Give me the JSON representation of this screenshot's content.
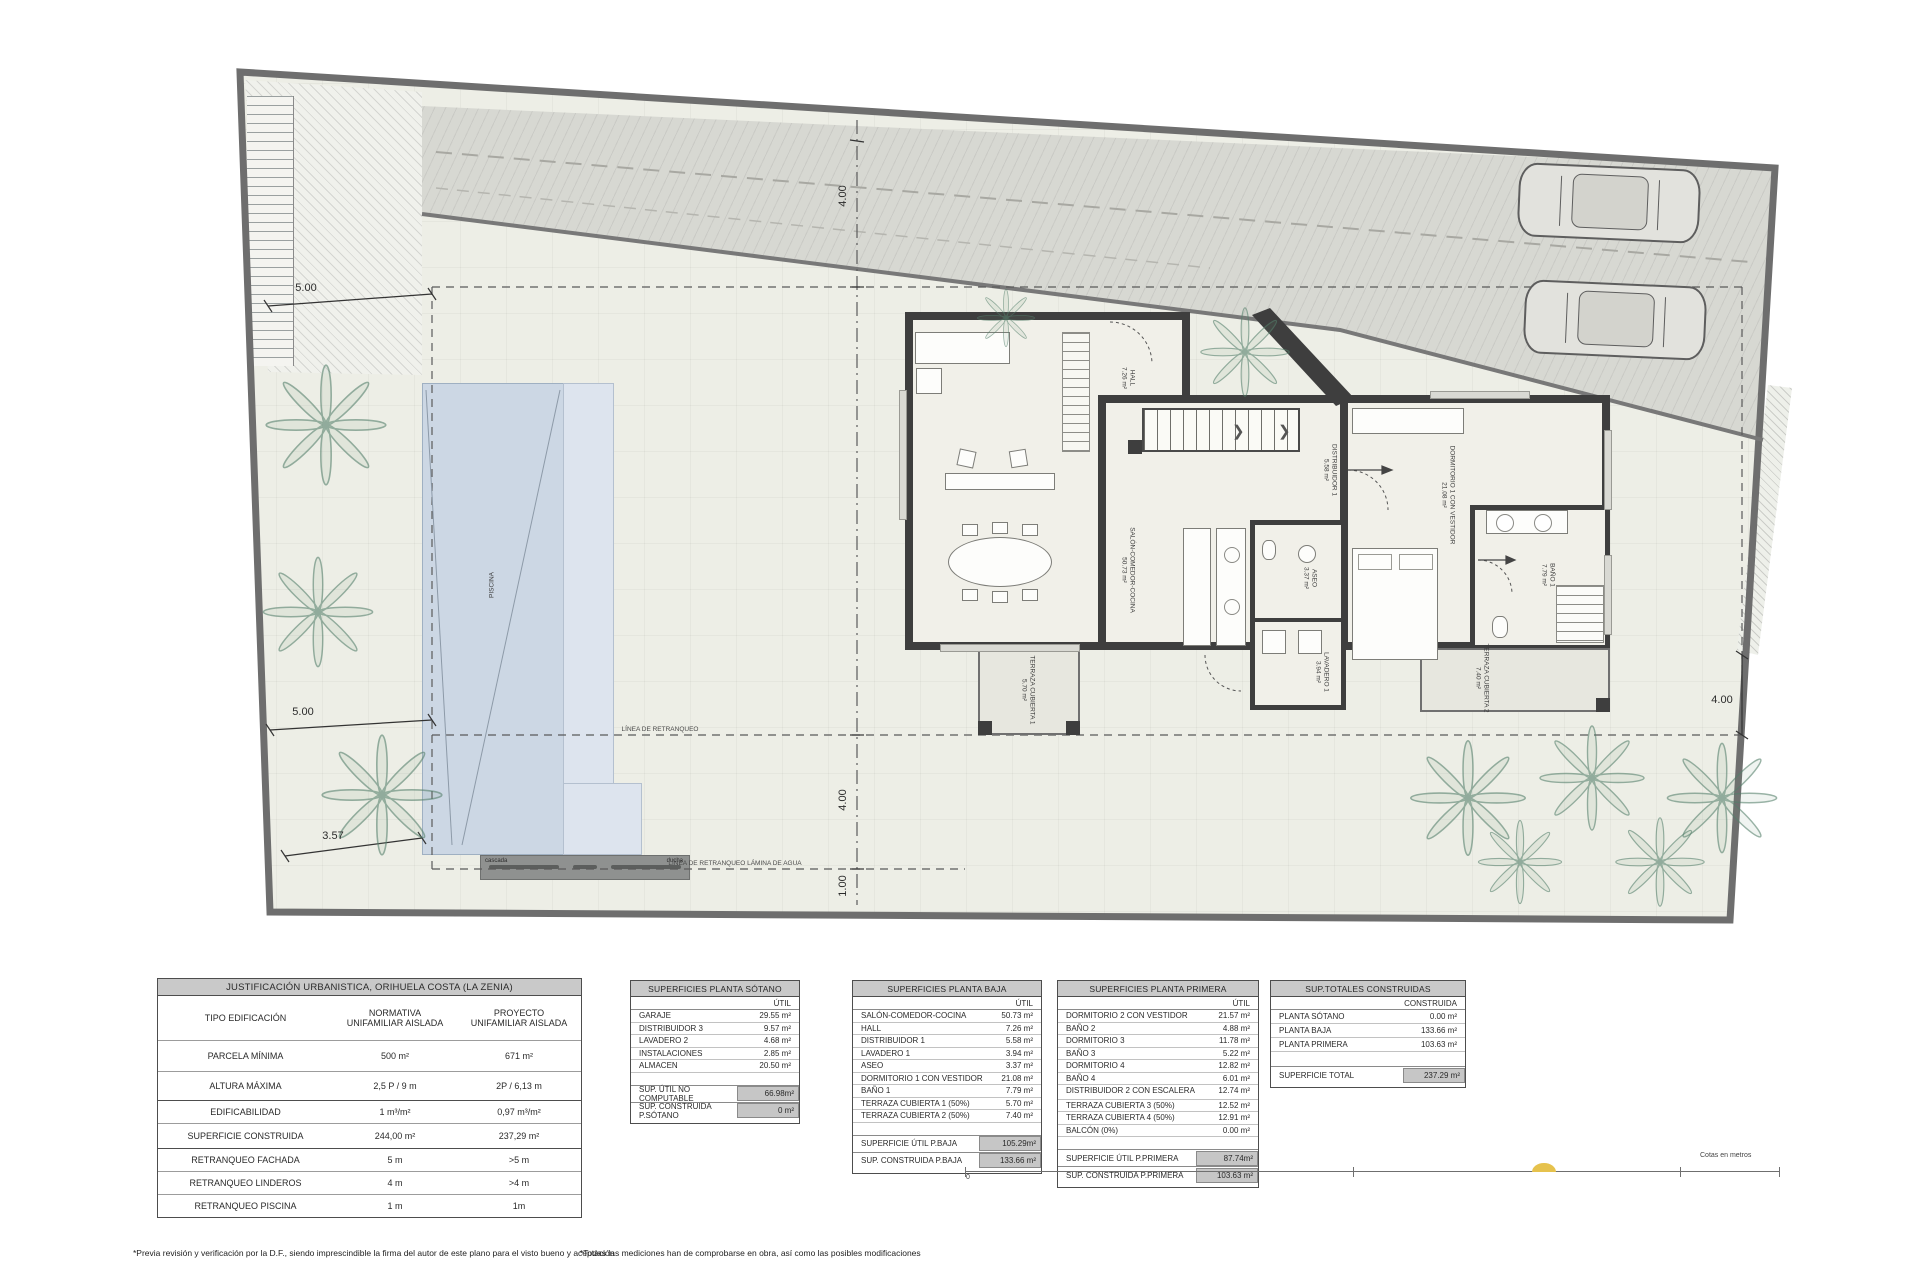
{
  "plan": {
    "pool": {
      "label": "PISCINA",
      "cascada": "cascada",
      "ducha": "ducha"
    },
    "rooms": [
      {
        "label": "HALL",
        "area": "7.26 m²"
      },
      {
        "label": "SALÓN-COMEDOR-COCINA",
        "area": "50.73 m²"
      },
      {
        "label": "TERRAZA CUBIERTA 1",
        "area": "5.70 m²"
      },
      {
        "label": "DISTRIBUIDOR 1",
        "area": "5.58 m²"
      },
      {
        "label": "DORMITORIO 1 CON VESTIDOR",
        "area": "21.08 m²"
      },
      {
        "label": "BAÑO 1",
        "area": "7.79 m²"
      },
      {
        "label": "ASEO",
        "area": "3.37 m²"
      },
      {
        "label": "LAVADERO 1",
        "area": "3.94 m²"
      },
      {
        "label": "TERRAZA CUBIERTA 2",
        "area": "7.40 m²"
      }
    ],
    "dimensions": {
      "top": "4.00",
      "left_upper": "5.00",
      "left_lower": "5.00",
      "left_bottom": "3.57",
      "right": "4.00",
      "bottom_center": "4.00",
      "bottom_inner": "1.00"
    },
    "setback_lines": {
      "retranqueo": "LÍNEA DE RETRANQUEO",
      "retranqueo_agua": "LÍNEA DE RETRANQUEO LÁMINA DE AGUA"
    }
  },
  "tables": {
    "urbanistica": {
      "title": "JUSTIFICACIÓN URBANISTICA, ORIHUELA COSTA (LA ZENIA)",
      "col_headers": {
        "normativa": "NORMATIVA",
        "proyecto": "PROYECTO"
      },
      "rows": [
        {
          "label": "TIPO EDIFICACIÓN",
          "normativa": "UNIFAMILIAR AISLADA",
          "proyecto": "UNIFAMILIAR AISLADA"
        },
        {
          "label": "PARCELA MÍNIMA",
          "normativa": "500 m²",
          "proyecto": "671 m²"
        },
        {
          "label": "ALTURA MÁXIMA",
          "normativa": "2,5 P / 9 m",
          "proyecto": "2P / 6,13 m"
        },
        {
          "label": "EDIFICABILIDAD",
          "normativa": "1 m³/m²",
          "proyecto": "0,97 m³/m²"
        },
        {
          "label": "SUPERFICIE CONSTRUIDA",
          "normativa": "244,00 m²",
          "proyecto": "237,29 m²"
        },
        {
          "label": "RETRANQUEO FACHADA",
          "normativa": "5 m",
          "proyecto": ">5 m"
        },
        {
          "label": "RETRANQUEO LINDEROS",
          "normativa": "4 m",
          "proyecto": ">4 m"
        },
        {
          "label": "RETRANQUEO PISCINA",
          "normativa": "1 m",
          "proyecto": "1m"
        }
      ]
    },
    "sotano": {
      "title": "SUPERFICIES PLANTA SÓTANO",
      "col_header": "ÚTIL",
      "rows": [
        {
          "label": "GARAJE",
          "value": "29.55 m²"
        },
        {
          "label": "DISTRIBUIDOR 3",
          "value": "9.57 m²"
        },
        {
          "label": "LAVADERO 2",
          "value": "4.68 m²"
        },
        {
          "label": "INSTALACIONES",
          "value": "2.85 m²"
        },
        {
          "label": "ALMACEN",
          "value": "20.50 m²"
        }
      ],
      "summary": [
        {
          "label": "SUP. ÚTIL NO COMPUTABLE",
          "value": "66.98m²"
        },
        {
          "label": "SUP. CONSTRUIDA P.SÓTANO",
          "value": "0 m²"
        }
      ]
    },
    "baja": {
      "title": "SUPERFICIES PLANTA BAJA",
      "col_header": "ÚTIL",
      "rows": [
        {
          "label": "SALÓN-COMEDOR-COCINA",
          "value": "50.73 m²"
        },
        {
          "label": "HALL",
          "value": "7.26 m²"
        },
        {
          "label": "DISTRIBUIDOR 1",
          "value": "5.58 m²"
        },
        {
          "label": "LAVADERO 1",
          "value": "3.94 m²"
        },
        {
          "label": "ASEO",
          "value": "3.37 m²"
        },
        {
          "label": "DORMITORIO 1 CON VESTIDOR",
          "value": "21.08 m²"
        },
        {
          "label": "BAÑO 1",
          "value": "7.79 m²"
        },
        {
          "label": "TERRAZA CUBIERTA 1 (50%)",
          "value": "5.70 m²"
        },
        {
          "label": "TERRAZA CUBIERTA 2 (50%)",
          "value": "7.40 m²"
        }
      ],
      "summary": [
        {
          "label": "SUPERFICIE ÚTIL P.BAJA",
          "value": "105.29m²"
        },
        {
          "label": "SUP. CONSTRUIDA P.BAJA",
          "value": "133.66 m²"
        }
      ]
    },
    "primera": {
      "title": "SUPERFICIES PLANTA PRIMERA",
      "col_header": "ÚTIL",
      "rows": [
        {
          "label": "DORMITORIO 2 CON VESTIDOR",
          "value": "21.57 m²"
        },
        {
          "label": "BAÑO 2",
          "value": "4.88 m²"
        },
        {
          "label": "DORMITORIO 3",
          "value": "11.78 m²"
        },
        {
          "label": "BAÑO 3",
          "value": "5.22 m²"
        },
        {
          "label": "DORMITORIO 4",
          "value": "12.82 m²"
        },
        {
          "label": "BAÑO 4",
          "value": "6.01 m²"
        },
        {
          "label": "DISTRIBUIDOR 2 CON ESCALERA",
          "value": "12.74 m²"
        },
        {
          "label": "TERRAZA CUBIERTA 3 (50%)",
          "value": "12.52 m²"
        },
        {
          "label": "TERRAZA CUBIERTA 4 (50%)",
          "value": "12.91 m²"
        },
        {
          "label": "BALCÓN (0%)",
          "value": "0.00 m²"
        }
      ],
      "summary": [
        {
          "label": "SUPERFICIE ÚTIL P.PRIMERA",
          "value": "87.74m²"
        },
        {
          "label": "SUP. CONSTRUIDA P.PRIMERA",
          "value": "103.63 m²"
        }
      ]
    },
    "totales": {
      "title": "SUP.TOTALES CONSTRUIDAS",
      "col_header": "CONSTRUIDA",
      "rows": [
        {
          "label": "PLANTA SÓTANO",
          "value": "0.00 m²"
        },
        {
          "label": "PLANTA BAJA",
          "value": "133.66 m²"
        },
        {
          "label": "PLANTA PRIMERA",
          "value": "103.63 m²"
        }
      ],
      "summary": [
        {
          "label": "SUPERFICIE TOTAL",
          "value": "237.29 m²"
        }
      ]
    }
  },
  "scalebar": {
    "zero": "0",
    "caption": "Cotas en metros"
  },
  "footnotes": {
    "left": "*Previa revisión y verificación por la D.F., siendo imprescindible la firma del autor de este plano para el visto bueno y aceptación",
    "right": "*Todas las mediciones han de comprobarse en obra, así como las posibles modificaciones"
  }
}
